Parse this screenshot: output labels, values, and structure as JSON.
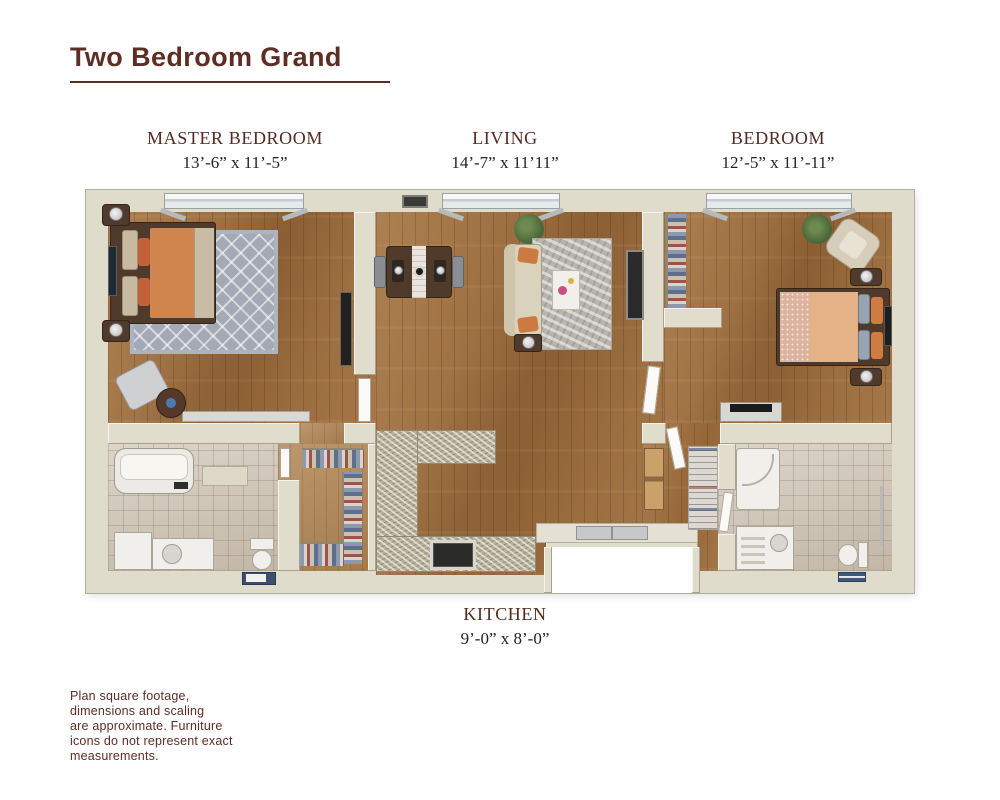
{
  "title": {
    "text": "Two Bedroom Grand"
  },
  "rooms": {
    "master_bedroom": {
      "label": "MASTER BEDROOM",
      "dimensions": "13’-6” x 11’-5”"
    },
    "living": {
      "label": "LIVING",
      "dimensions": "14’-7” x 11’11”"
    },
    "bedroom": {
      "label": "BEDROOM",
      "dimensions": "12’-5” x 11’-11”"
    },
    "kitchen": {
      "label": "KITCHEN",
      "dimensions": "9’-0” x 8’-0”"
    }
  },
  "disclaimer": "Plan square footage,\ndimensions and scaling\nare approximate. Furniture\nicons do not represent exact\nmeasurements.",
  "colors": {
    "accent_maroon": "#5e2d24",
    "room_label": "#532a20",
    "dimensions_text": "#2a211c",
    "wall": "#dfdccb",
    "wood_floor": "#9b6c3f",
    "tile_floor": "#cfc5b6",
    "rug_gray": "#a3aab6",
    "bedding_orange": "#d0854e",
    "bedding_peach": "#e5b287",
    "counter_granite": "#b7b098"
  },
  "furniture": {
    "master_bedroom": [
      "bed",
      "diamond-rug",
      "nightstands-with-lamps",
      "wall-art",
      "wall-tv",
      "accent-chair",
      "round-side-table",
      "low-console",
      "window"
    ],
    "living": [
      "dining-table",
      "dining-chairs",
      "sofa",
      "area-rug",
      "coffee-table",
      "lamp-side-table",
      "media-console",
      "houseplant",
      "air-vent",
      "window"
    ],
    "bedroom": [
      "bed",
      "nightstands-with-lamps",
      "armchair",
      "houseplant",
      "dresser-with-tv",
      "closet-rod",
      "wall-tv",
      "window"
    ],
    "kitchen": [
      "l-shaped-granite-counter",
      "range",
      "double-sink"
    ],
    "master_bathroom": [
      "bathtub",
      "bath-mat",
      "storage-cabinet",
      "vanity-sink",
      "toilet",
      "towel-mat"
    ],
    "walk_in_closet": [
      "hanging-clothes-rods"
    ],
    "hallway": [
      "pantry-cabinet",
      "linen-shelves"
    ],
    "second_bathroom": [
      "shower",
      "vanity-sink",
      "toilet",
      "towel-bar",
      "towels"
    ]
  }
}
